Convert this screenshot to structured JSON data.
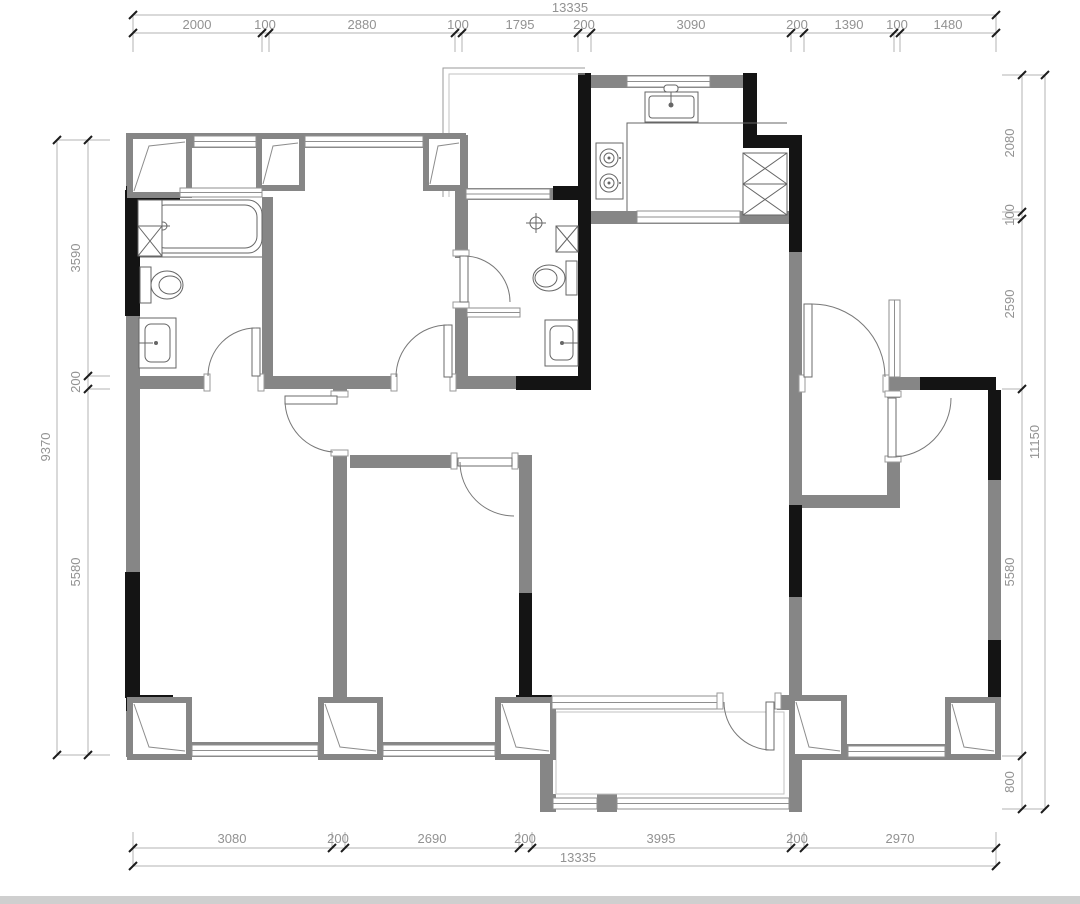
{
  "drawing": {
    "type": "apartment-floor-plan",
    "units": "mm",
    "dimensions": {
      "top": {
        "total": "13335",
        "segments": [
          "2000",
          "100",
          "2880",
          "100",
          "1795",
          "200",
          "3090",
          "200",
          "1390",
          "100",
          "1480"
        ]
      },
      "bottom": {
        "total": "13335",
        "segments": [
          "3080",
          "200",
          "2690",
          "200",
          "3995",
          "200",
          "2970"
        ]
      },
      "left": {
        "total": "9370",
        "segments": [
          "3590",
          "200",
          "5580"
        ]
      },
      "right": {
        "total": "11150",
        "segments": [
          "2080",
          "100",
          "2590",
          "5580",
          "800"
        ]
      }
    },
    "colors": {
      "wall_gray": "#868686",
      "wall_black": "#141414",
      "dim_text": "#929292",
      "dim_line": "#b3b3b3",
      "fixture_line": "#666666",
      "footer_bar": "#cfcfcf"
    }
  }
}
